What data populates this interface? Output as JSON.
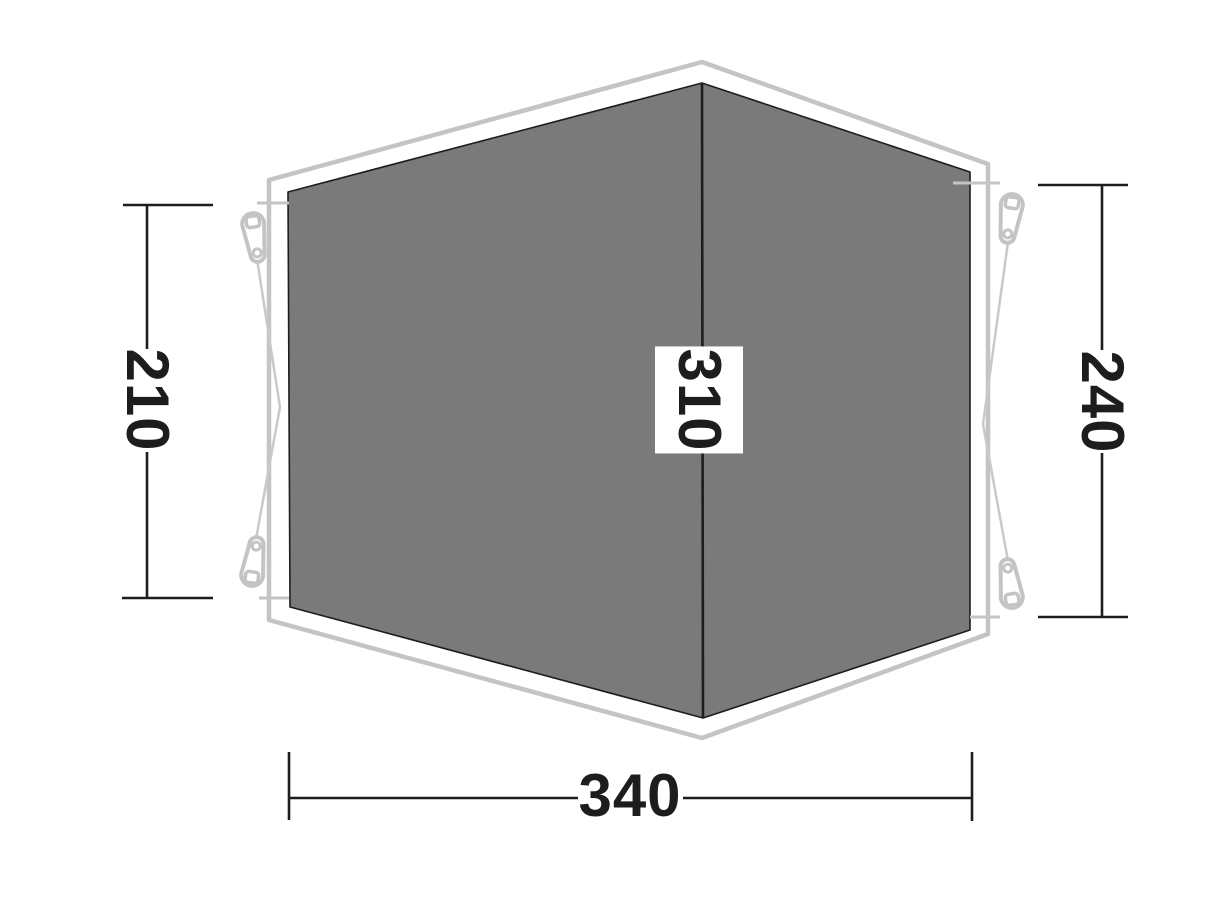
{
  "diagram": {
    "type": "tent-footprint-dimension-diagram",
    "dimensions": {
      "left": "210",
      "center": "310",
      "right": "240",
      "bottom": "340"
    },
    "colors": {
      "background": "#ffffff",
      "groundsheet_fill": "#7a7a7a",
      "groundsheet_edge": "#1d1d1b",
      "outer_outline": "#c4c4c4",
      "guy_rope": "#c9c9c9",
      "dimension_line": "#1d1d1b",
      "label_text": "#1d1d1b",
      "label_box": "#ffffff"
    },
    "icons": {
      "peg": "tent-peg-icon"
    }
  }
}
